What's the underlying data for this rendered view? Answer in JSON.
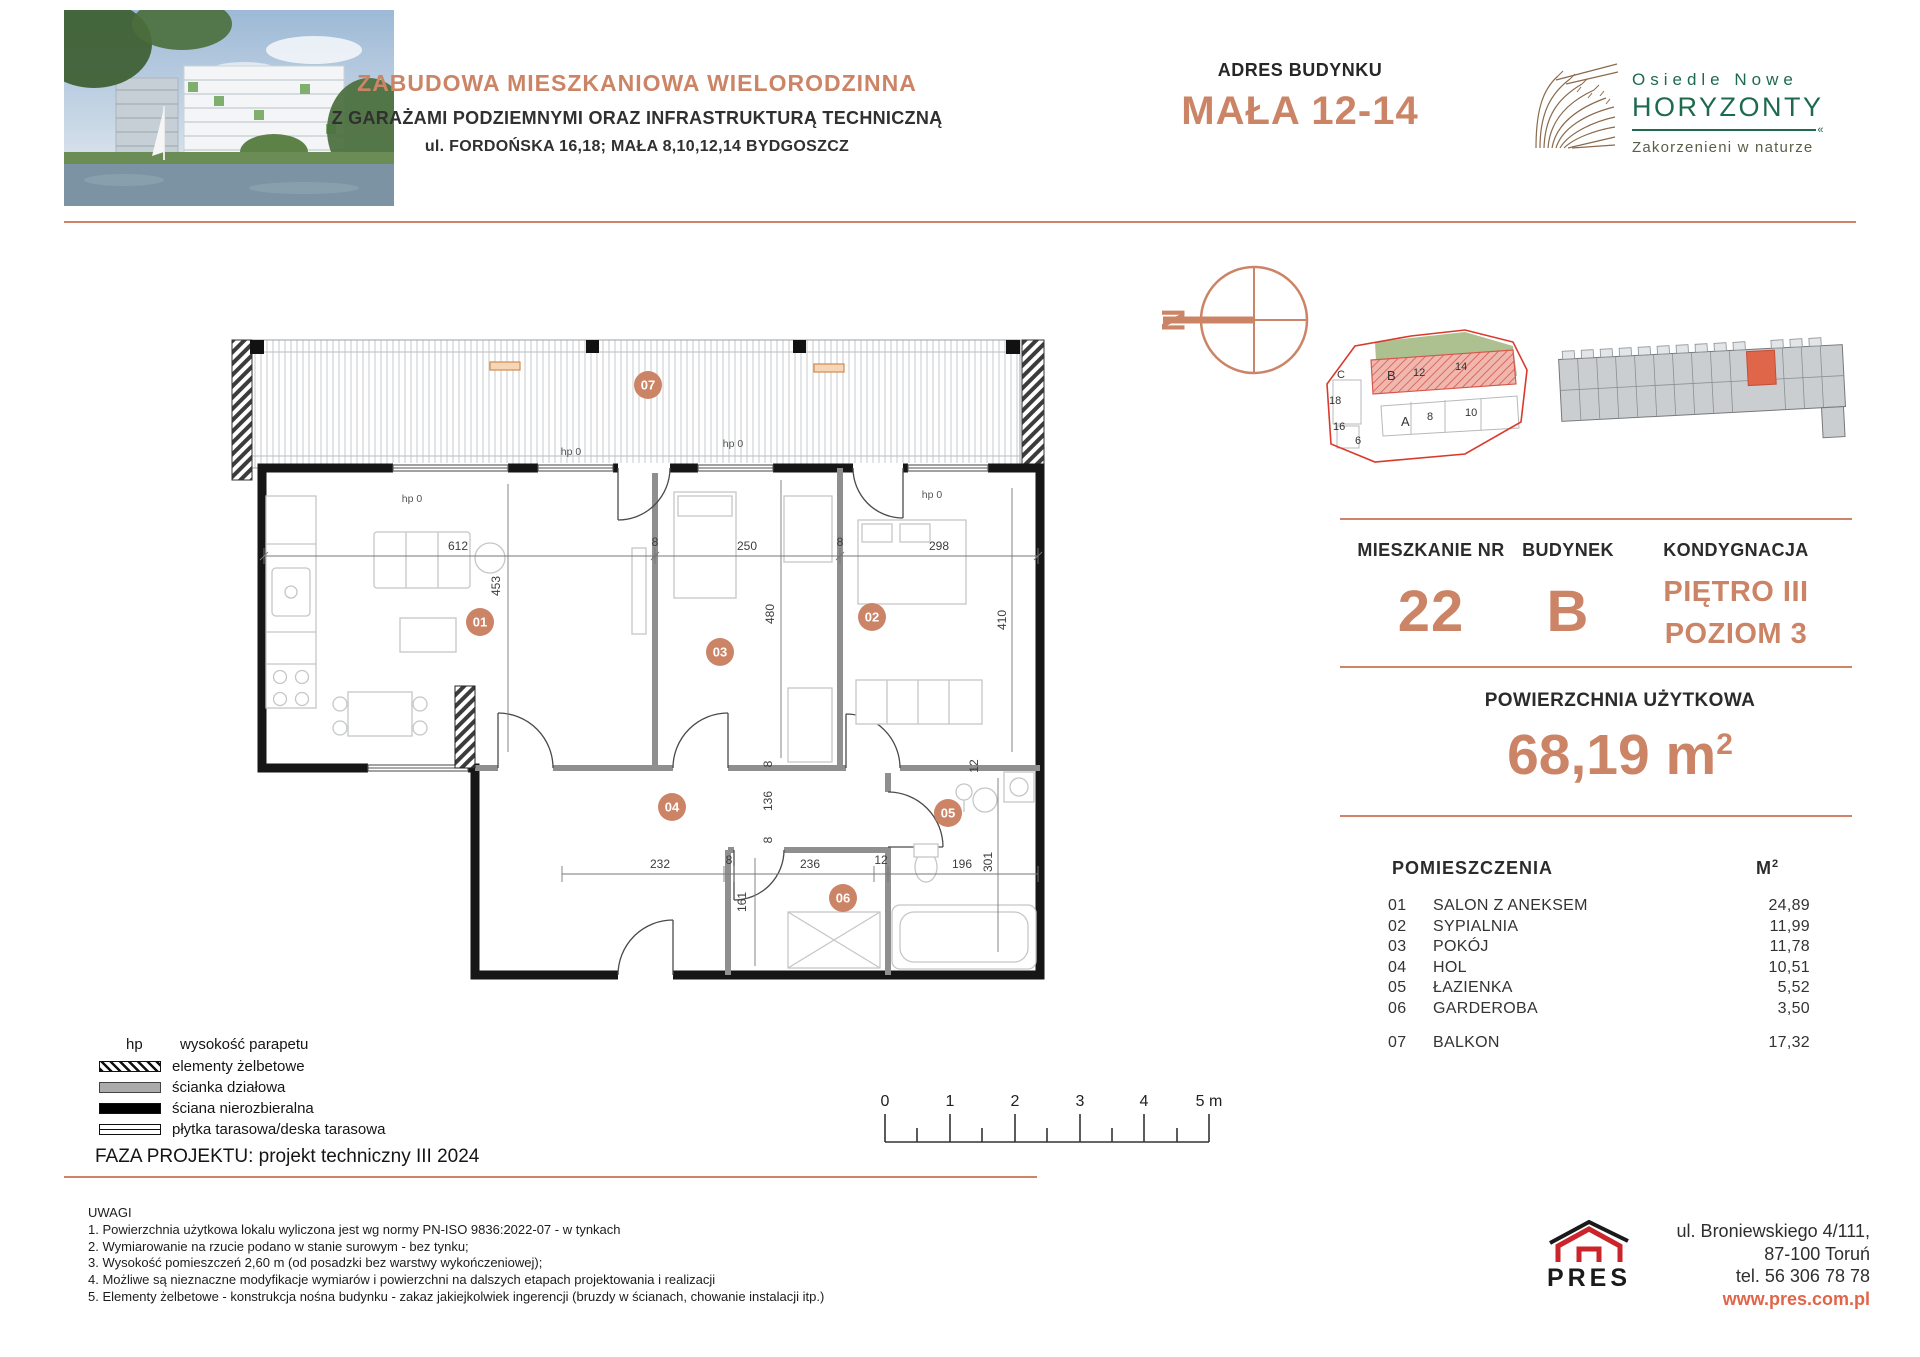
{
  "header": {
    "title_line1": "ZABUDOWA MIESZKANIOWA WIELORODZINNA",
    "title_line2": "Z GARAŻAMI PODZIEMNYMI ORAZ INFRASTRUKTURĄ TECHNICZNĄ",
    "title_line3": "ul. FORDOŃSKA 16,18; MAŁA 8,10,12,14 BYDGOSZCZ",
    "address_label": "ADRES BUDYNKU",
    "address_value": "MAŁA 12-14",
    "logo_line1": "Osiedle Nowe",
    "logo_line2": "HORYZONTY",
    "logo_tagline": "Zakorzenieni w naturze"
  },
  "info": {
    "apartment_label": "MIESZKANIE NR",
    "apartment_value": "22",
    "building_label": "BUDYNEK",
    "building_value": "B",
    "floor_label": "KONDYGNACJA",
    "floor_line1": "PIĘTRO III",
    "floor_line2": "POZIOM 3",
    "area_label": "POWIERZCHNIA UŻYTKOWA",
    "area_value": "68,19 m",
    "area_sup": "2"
  },
  "rooms": {
    "title": "POMIESZCZENIA",
    "unit": "M",
    "unit_sup": "2",
    "items": [
      {
        "no": "01",
        "name": "SALON Z ANEKSEM",
        "area": "24,89"
      },
      {
        "no": "02",
        "name": "SYPIALNIA",
        "area": "11,99"
      },
      {
        "no": "03",
        "name": "POKÓJ",
        "area": "11,78"
      },
      {
        "no": "04",
        "name": "HOL",
        "area": "10,51"
      },
      {
        "no": "05",
        "name": "ŁAZIENKA",
        "area": "5,52"
      },
      {
        "no": "06",
        "name": "GARDEROBA",
        "area": "3,50"
      },
      {
        "no": "07",
        "name": "BALKON",
        "area": "17,32"
      }
    ]
  },
  "plan": {
    "north": "N",
    "hp": "hp 0",
    "dims": {
      "top_a": "612",
      "top_b": "8",
      "top_c": "250",
      "top_d": "8",
      "top_e": "298",
      "v_salon": "453",
      "v_room3": "480",
      "v_room2": "410",
      "bot_a": "232",
      "bot_b": "8",
      "bot_c": "236",
      "bot_d": "12",
      "bot_e": "196",
      "v_hol": "136",
      "v_h8a": "8",
      "v_h8b": "8",
      "v_gard": "161",
      "v_bath": "301",
      "v_d12": "12"
    },
    "scale": {
      "s0": "0",
      "s1": "1",
      "s2": "2",
      "s3": "3",
      "s4": "4",
      "s5": "5 m"
    },
    "site": {
      "a": "A",
      "b": "B",
      "c": "C",
      "n6": "6",
      "n8": "8",
      "n10": "10",
      "n12": "12",
      "n14": "14",
      "n16": "16",
      "n18": "18"
    }
  },
  "legend": {
    "hp_key": "hp",
    "hp_label": "wysokość parapetu",
    "item1": "elementy żelbetowe",
    "item2": "ścianka działowa",
    "item3": "ściana nierozbieralna",
    "item4": "płytka tarasowa/deska tarasowa",
    "phase": "FAZA PROJEKTU: projekt techniczny III 2024"
  },
  "notes": {
    "title": "UWAGI",
    "n1": "1. Powierzchnia użytkowa lokalu wyliczona jest wg normy PN-ISO 9836:2022-07 - w tynkach",
    "n2": "2. Wymiarowanie na rzucie podano w stanie surowym - bez tynku;",
    "n3": "3. Wysokość pomieszczeń 2,60 m (od posadzki bez warstwy wykończeniowej);",
    "n4": "4. Możliwe są nieznaczne modyfikacje wymiarów i powierzchni na dalszych etapach projektowania i realizacji",
    "n5": "5. Elementy żelbetowe - konstrukcja nośna budynku - zakaz jakiejkolwiek ingerencji (bruzdy w ścianach, chowanie instalacji itp.)"
  },
  "footer": {
    "company": "PRES",
    "addr1": "ul. Broniewskiego 4/111,",
    "addr2": "87-100 Toruń",
    "addr3": "tel. 56 306 78 78",
    "website": "www.pres.com.pl"
  }
}
